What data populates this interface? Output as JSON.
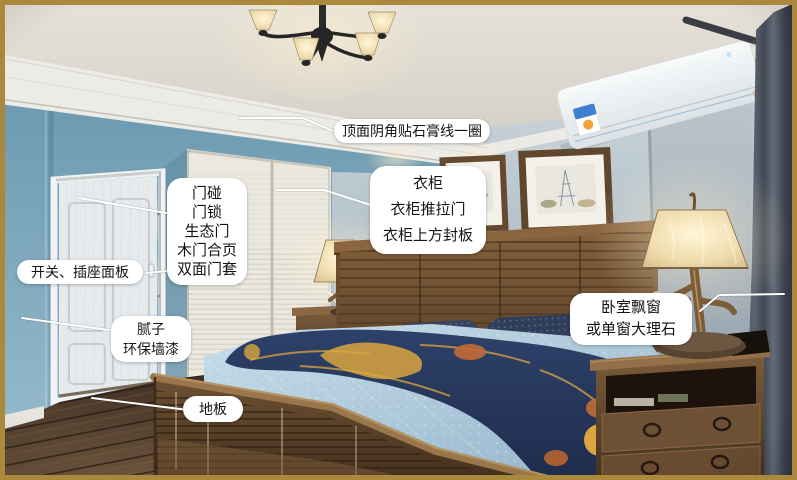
{
  "labels": {
    "gypsum": {
      "text": "顶面阴角贴石膏线一圈"
    },
    "door_hardware": {
      "lines": [
        "门碰",
        "门锁",
        "生态门",
        "木门合页",
        "双面门套"
      ]
    },
    "switch_panel": {
      "text": "开关、插座面板"
    },
    "putty_paint": {
      "lines": [
        "腻子",
        "环保墙漆"
      ]
    },
    "floor": {
      "text": "地板"
    },
    "wardrobe": {
      "lines": [
        "衣柜",
        "衣柜推拉门",
        "衣柜上方封板"
      ]
    },
    "bay_window": {
      "lines": [
        "卧室飘窗",
        "或单窗大理石"
      ]
    }
  },
  "style": {
    "photo_border_color": "#aa893c",
    "label_background": "#ffffff",
    "label_text_color": "#141414",
    "leader_line_color": "#ffffff"
  }
}
